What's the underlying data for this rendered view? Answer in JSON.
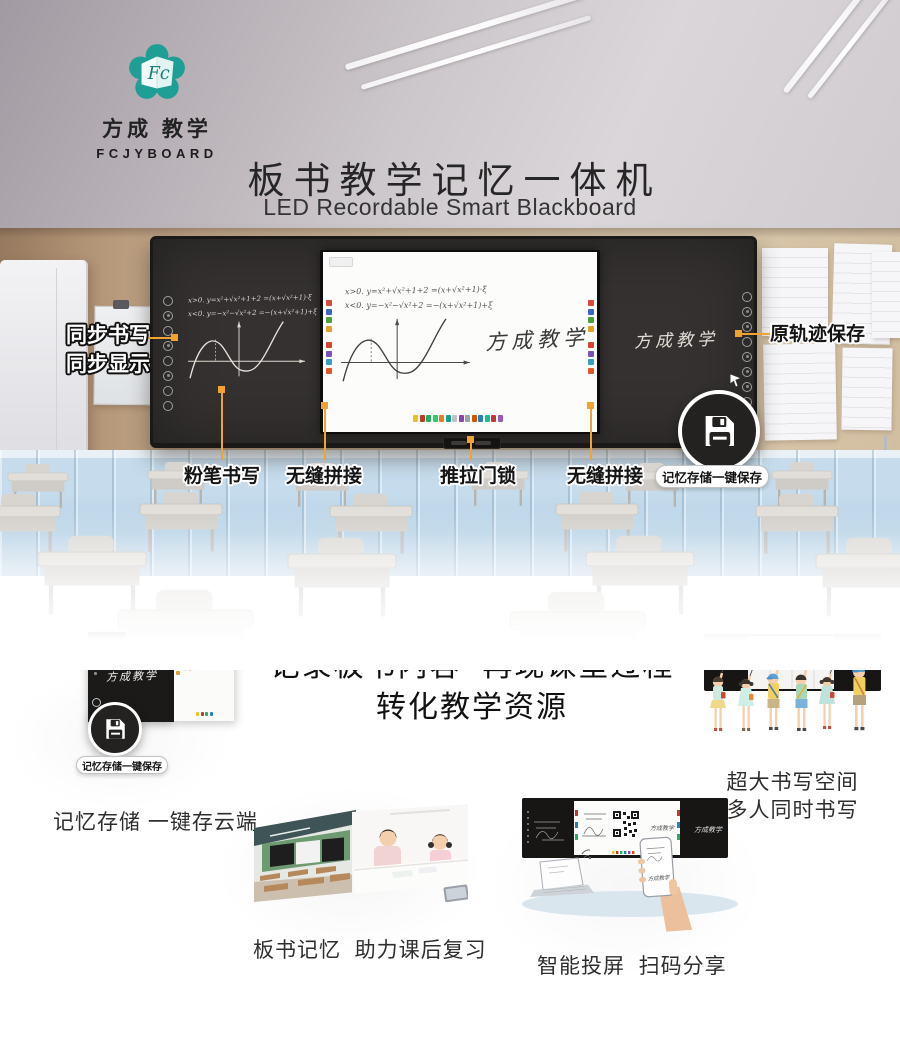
{
  "brand": {
    "logo_monogram": "Fc",
    "name_cn": "方成 教学",
    "name_en": "FCJYBOARD",
    "script": "方成教学"
  },
  "header": {
    "title": "板书教学记忆一体机",
    "subtitle": "LED Recordable Smart Blackboard"
  },
  "hero": {
    "annotation_left_line1": "同步书写",
    "annotation_left_line2": "同步显示",
    "annotation_right": "原轨迹保存",
    "bottom_labels": [
      "粉笔书写",
      "无缝拼接",
      "推拉门锁",
      "无缝拼接"
    ],
    "save_badge": "记忆存储一键保存",
    "board": {
      "formula1": "x>0. y=x²+√x²+1+2 =(x+√x²+1)·ξ",
      "formula2": "x<0. y=−x²−√x²+2 =−(x+√x²+1)+ξ"
    }
  },
  "section2": {
    "headline_line1": "记录板书内容  再现课堂过程",
    "headline_line2": "转化教学资源",
    "feature_memory": {
      "caption": "记忆存储 一键存云端"
    },
    "feature_space": {
      "caption_line1": "超大书写空间",
      "caption_line2": "多人同时书写"
    },
    "feature_review": {
      "caption": "板书记忆  助力课后复习"
    },
    "feature_cast": {
      "caption": "智能投屏  扫码分享"
    }
  },
  "colors": {
    "accent_orange": "#f0a232",
    "brand_teal": "#1f9e96",
    "board_dark": "#2b2827"
  }
}
